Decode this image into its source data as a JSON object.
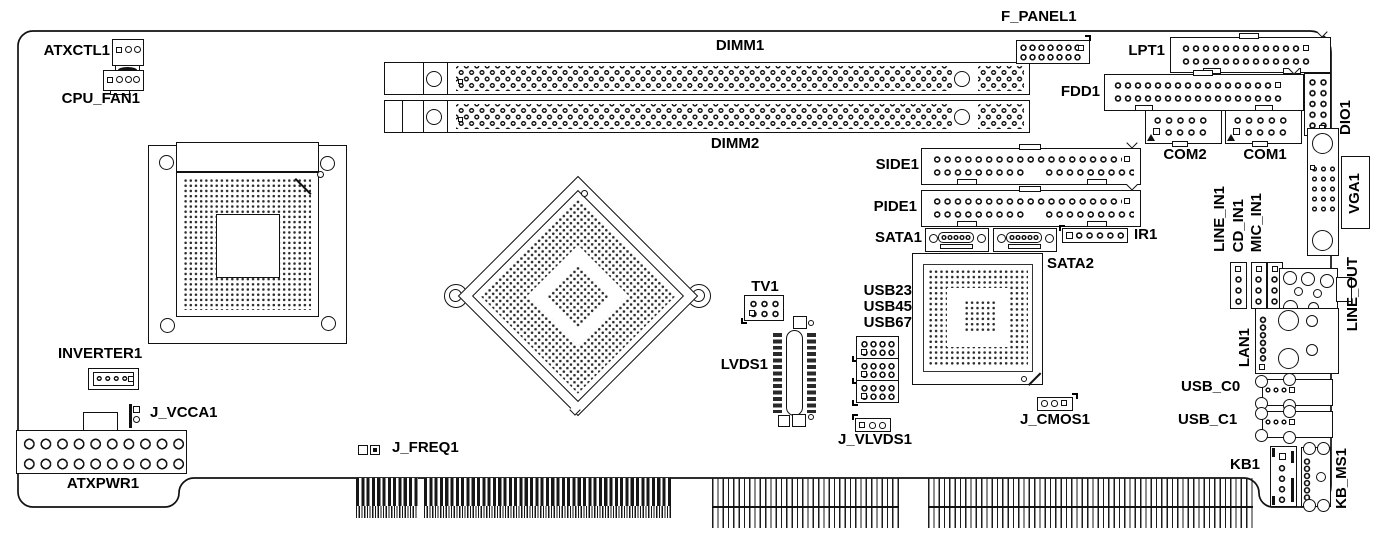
{
  "colors": {
    "ink": "#111111",
    "background": "#ffffff"
  },
  "labels": {
    "atxctl1": "ATXCTL1",
    "cpu_fan1": "CPU_FAN1",
    "inverter1": "INVERTER1",
    "j_vcca1": "J_VCCA1",
    "atxpwr1": "ATXPWR1",
    "j_freq1": "J_FREQ1",
    "dimm1": "DIMM1",
    "dimm2": "DIMM2",
    "f_panel1": "F_PANEL1",
    "lpt1": "LPT1",
    "fdd1": "FDD1",
    "dio1": "DIO1",
    "com1": "COM1",
    "com2": "COM2",
    "vga1": "VGA1",
    "side1": "SIDE1",
    "pide1": "PIDE1",
    "sata1": "SATA1",
    "sata2": "SATA2",
    "ir1": "IR1",
    "tv1": "TV1",
    "lvds1": "LVDS1",
    "usb23": "USB23",
    "usb45": "USB45",
    "usb67": "USB67",
    "j_vlvds1": "J_VLVDS1",
    "j_cmos1": "J_CMOS1",
    "line_in1": "LINE_IN1",
    "cd_in1": "CD_IN1",
    "mic_in1": "MIC_IN1",
    "line_out": "LINE_OUT",
    "lan1": "LAN1",
    "usb_c0": "USB_C0",
    "usb_c1": "USB_C1",
    "kb1": "KB1",
    "kb_ms1": "KB_MS1"
  }
}
